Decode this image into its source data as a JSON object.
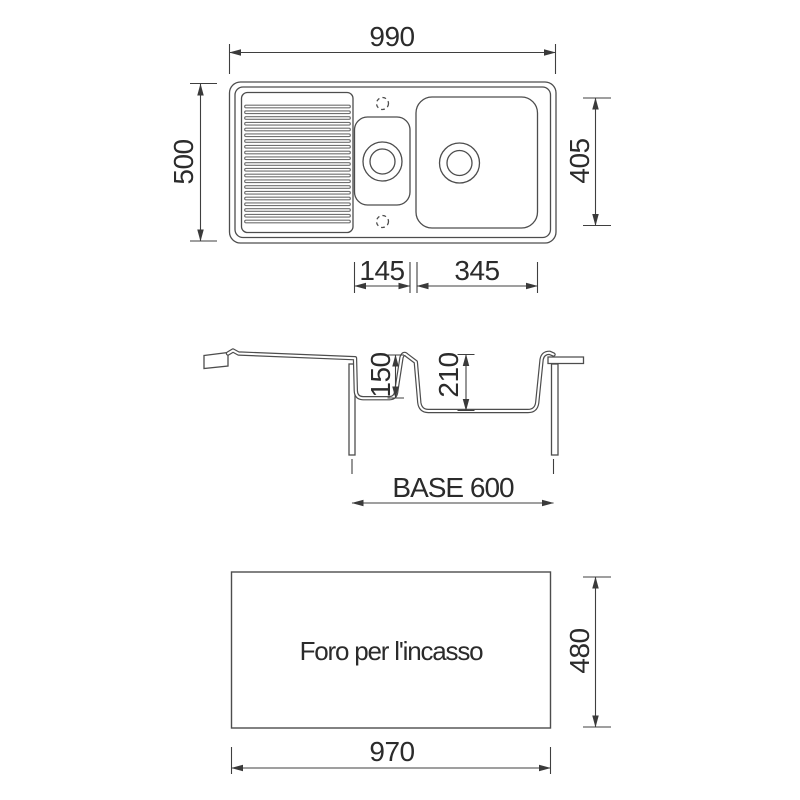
{
  "drawing": {
    "top_view": {
      "overall_width": "990",
      "overall_depth": "500",
      "main_bowl_depth_dim": "405",
      "half_bowl_width": "145",
      "main_bowl_width": "345"
    },
    "section_view": {
      "half_bowl_depth": "150",
      "main_bowl_depth": "210",
      "base_cabinet": "BASE 600"
    },
    "cutout_view": {
      "caption": "Foro per l'incasso",
      "cutout_width": "970",
      "cutout_depth": "480"
    },
    "colors": {
      "line": "#4d4d4d",
      "text": "#2b2b2b",
      "background": "#ffffff"
    }
  }
}
